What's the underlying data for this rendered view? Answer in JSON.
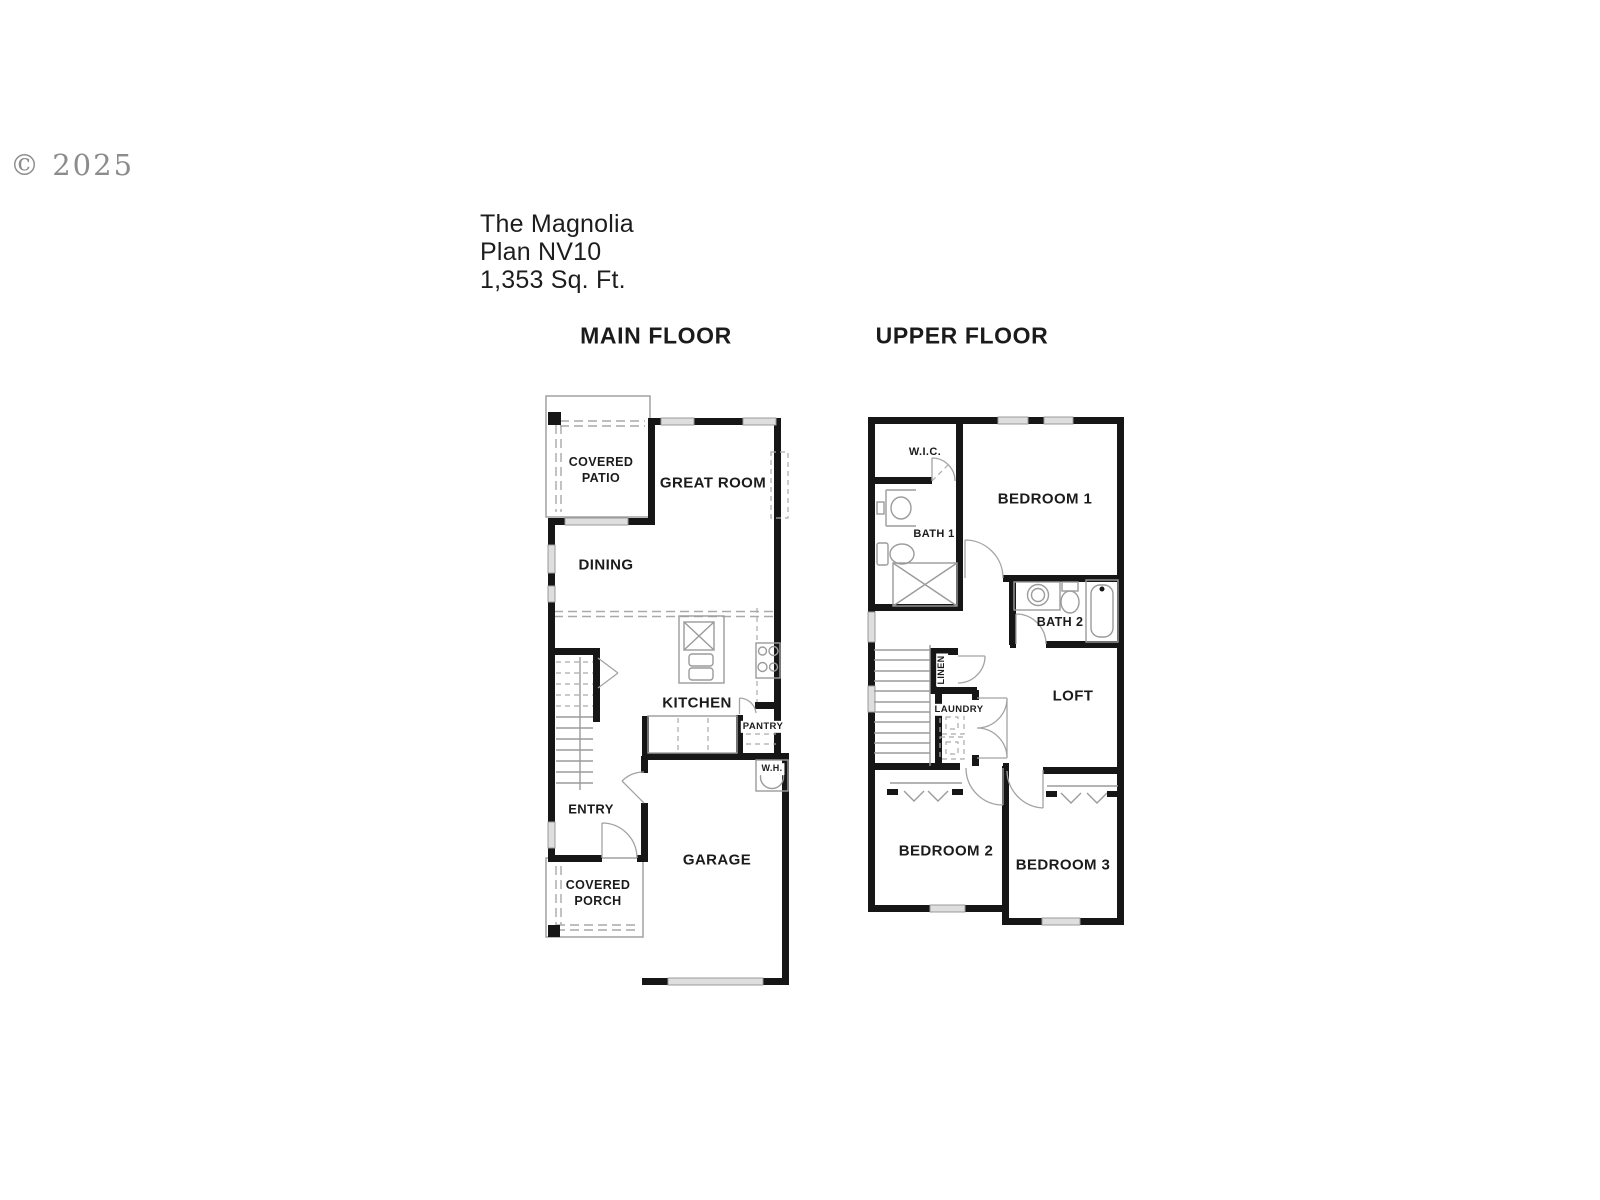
{
  "watermark": {
    "text": "© 2025"
  },
  "title": {
    "name": "The Magnolia",
    "plan": "Plan NV10",
    "area": "1,353 Sq. Ft."
  },
  "colors": {
    "background": "#ffffff",
    "wall": "#161616",
    "thin_line": "#9b9b9b",
    "dashed_line": "#a9a9a9",
    "text": "#1b1b1b",
    "watermark": "#8c8c8c",
    "window_fill": "#dedede"
  },
  "main_floor": {
    "heading": "MAIN FLOOR",
    "labels": {
      "covered_patio": "COVERED\nPATIO",
      "great_room": "GREAT ROOM",
      "dining": "DINING",
      "kitchen": "KITCHEN",
      "pantry": "PANTRY",
      "water_heater": "W.H.",
      "entry": "ENTRY",
      "garage": "GARAGE",
      "covered_porch": "COVERED\nPORCH"
    }
  },
  "upper_floor": {
    "heading": "UPPER FLOOR",
    "labels": {
      "wic": "W.I.C.",
      "bedroom1": "BEDROOM 1",
      "bath1": "BATH 1",
      "bath2": "BATH 2",
      "linen": "LINEN",
      "laundry": "LAUNDRY",
      "loft": "LOFT",
      "bedroom2": "BEDROOM 2",
      "bedroom3": "BEDROOM 3"
    }
  }
}
